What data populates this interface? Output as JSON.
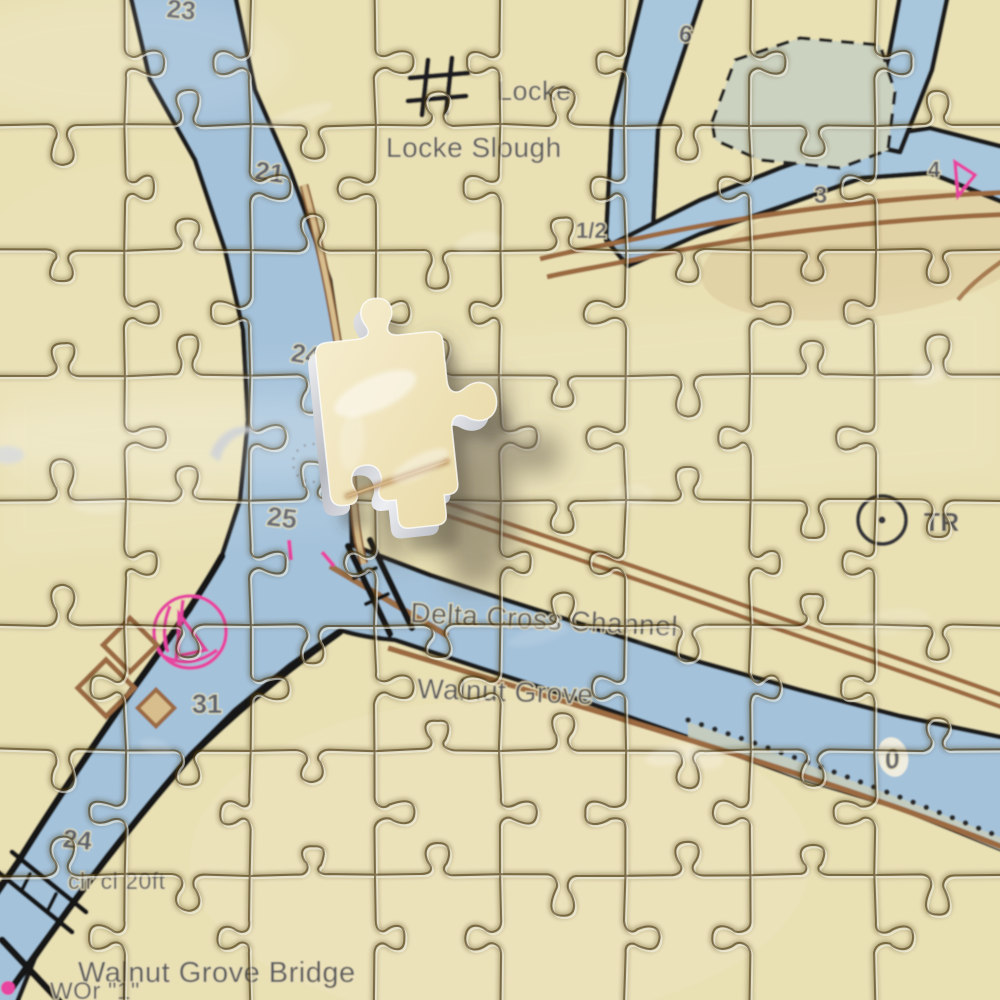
{
  "labels": {
    "locke": "Locke",
    "locke_slough": "Locke Slough",
    "delta_cross_channel": "Delta Cross Channel",
    "walnut_grove": "Walnut Grove",
    "walnut_grove_bridge": "Walnut Grove Bridge",
    "light_label": "WOr \"1\"",
    "bridge_clearance": "clr cl 20ft",
    "tower": "TR"
  },
  "soundings": {
    "s23": "23",
    "s21": "21",
    "s24a": "24",
    "s25": "25",
    "s31": "31",
    "s24b": "24",
    "s6": "6",
    "shalf": "1/2",
    "s3": "3",
    "s4": "4",
    "s0": "0"
  },
  "symbols": {
    "building_hash": "building-block-symbol",
    "tower_circle": "tower-circle-symbol",
    "marina_circle": "marina-circle-symbol",
    "pink_beacon": "pink-beacon-symbol",
    "bridge": "bridge-symbol",
    "shoal_dots": "dotted-shoal-line",
    "marsh_dashed": "dashed-marsh-outline",
    "puzzle_piece": "loose-puzzle-piece"
  },
  "colors": {
    "land": "#e9e0b4",
    "water": "#a4c2da",
    "marsh": "#ccd2c0",
    "road_brown": "#9c6b3f",
    "road_fill": "#d8bd8d",
    "magenta": "#e645a0",
    "ink": "#1d1d1f",
    "label_gray": "#4d4e55",
    "piece_cream": "#f2e7c2",
    "piece_side_silver": "#c9ccd2"
  }
}
